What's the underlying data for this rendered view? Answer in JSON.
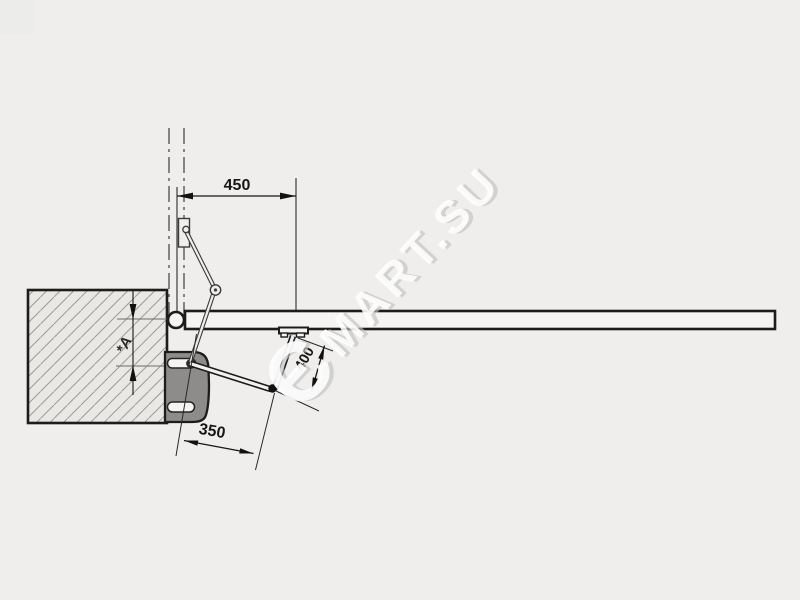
{
  "page": {
    "background_color": "#efeeec"
  },
  "colors": {
    "line": "#1c1c1c",
    "wall_fill": "#e9e8e5",
    "hatch_line": "#9b9b99",
    "bracket_fill": "#8d8c8a",
    "bar_fill": "#f5f4f2",
    "watermark_text": "#ffffff",
    "watermark_shadow": "#c3c2c0"
  },
  "diagram": {
    "dimensions": {
      "d450": "450",
      "d400": "400",
      "d350": "350",
      "dA": "*A"
    },
    "watermark": {
      "logo": "Є",
      "text": "MART.SU"
    }
  }
}
